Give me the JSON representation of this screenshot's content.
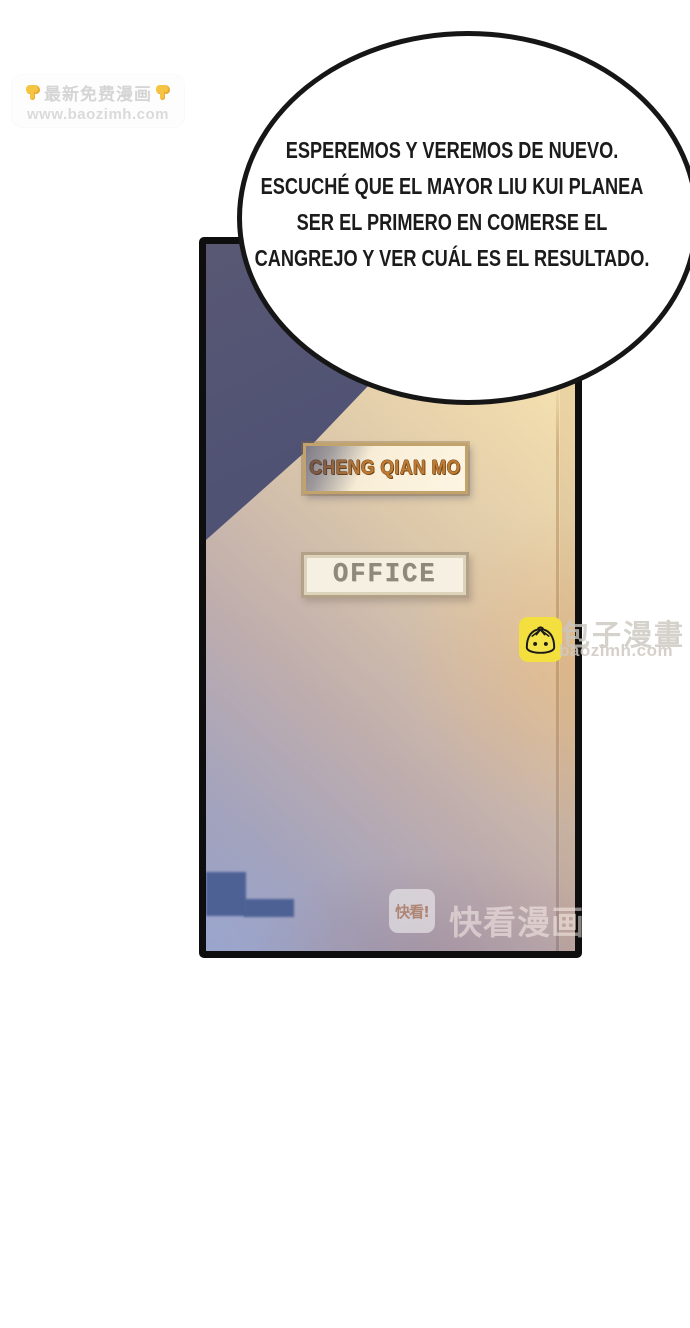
{
  "watermarks": {
    "top": {
      "message": "最新免费漫画",
      "site": "www.baozimh.com"
    },
    "side": {
      "brand": "包子漫畫",
      "site": "baozimh.com"
    },
    "bottom": {
      "badge": "快看!",
      "label": "快看漫画"
    }
  },
  "speech_bubble": {
    "lines": [
      "ESPEREMOS Y VEREMOS DE NUEVO.",
      "ESCUCHÉ QUE EL MAYOR LIU KUI PLANEA",
      "SER EL PRIMERO EN COMERSE EL",
      "CANGREJO Y VER CUÁL ES EL RESULTADO."
    ]
  },
  "door": {
    "name_sign": "CHENG QIAN MO",
    "office_sign": "OFFICE"
  },
  "colors": {
    "shadow_blue": "#3c497f",
    "door_cream": "#f9e8b3",
    "door_lavender": "#97a0c4",
    "logo_yellow": "#f3df3d",
    "name_sign_text": "#bf7a33",
    "office_sign_text": "#8f897b"
  }
}
